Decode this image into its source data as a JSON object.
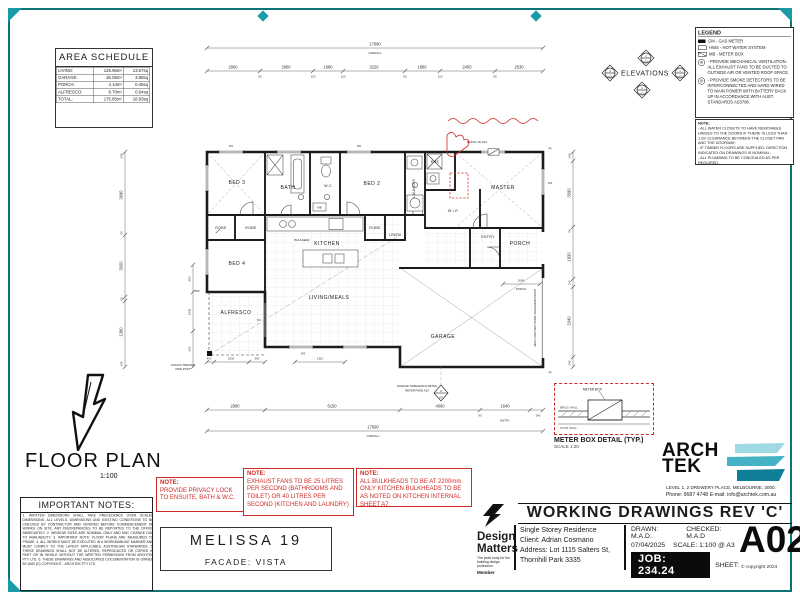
{
  "area_schedule": {
    "title": "AREA SCHEDULE",
    "rows": [
      {
        "name": "LIVING:",
        "m2": "126.96m²",
        "sq": "13.67sq"
      },
      {
        "name": "GARAGE:",
        "m2": "36.05m²",
        "sq": "3.88sq"
      },
      {
        "name": "PORCH:",
        "m2": "4.14m²",
        "sq": "0.45sq"
      },
      {
        "name": "ALFRESCO:",
        "m2": "8.70m²",
        "sq": "0.94sq"
      },
      {
        "name": "TOTAL:",
        "m2": "175.85m²",
        "sq": "18.93sq"
      }
    ]
  },
  "floor_plan_title": {
    "label": "FLOOR PLAN",
    "scale": "1:100"
  },
  "elevations": {
    "label": "ELEVATIONS",
    "top": "2",
    "right": "1",
    "bottom": "4",
    "left": "3",
    "sheet": "A3"
  },
  "legend": {
    "title": "LEGEND",
    "items": [
      "GM  -  GAS METER",
      "HWS  -  HOT WATER SYSTEM",
      "MB  -  METER BOX"
    ],
    "vent_note": "-  PROVIDE MECHANICAL VENTILATION. ALL EXHAUST FANS TO BE DUCTED TO OUTSIDE AIR OR VENTED ROOF SPACE.",
    "smoke_note": "-  PROVIDE SMOKE DETECTORS TO BE INTERCONNECTED AND HARD WIRED TO MAIN POWER WITH BATTERY BACK UP IN ACCORDANCE WITH AUST. STANDARDS AS3786."
  },
  "legend_note": {
    "title": "NOTE:",
    "line1": "- ALL WATER CLOSETS TO HAVE REMOVABLE HINGES TO THE DOORS IF THERE IS LESS THAN 1.2m CLEARANCE BETWEEN THE CLOSET PAN AND THE DOORWAY.",
    "line2": "- IF TIMBER FLOORS ARE SUPPLIED, DIRECTION INDICATED ON DRAWINGS IS NOMINAL.",
    "line3": "- ALL PLUMBING TO BE CONCEALED AS PER REQUIRED."
  },
  "important_notes": {
    "title": "IMPORTANT NOTES:",
    "body": "1. WRITTEN DIMENSIONS SHALL TAKE PRECEDENCE OVER SCALED DIMENSIONS. ALL LEVELS, DIMENSIONS AND EXISTING CONDITIONS TO BE CHECKED BY CONTRACTOR AND VERIFIED BEFORE COMMENCEMENT OF WORKS ON SITE. ANY DISCREPANCIES TO BE REPORTED TO THE OFFICE IMMEDIATELY. 2. WINDOW SIZES ARE NOMINAL ONLY AND MAY CHANGE DUE TO AVAILABILITY. 3. IMPORTANT NOTE: FLOOR PLANS ARE MEASURED TO FRAME. 4. ALL WORKS MUST BE EXECUTED IN A WORKMANLIKE MANNER AND MUST COMPLY TO THE LATEST APPLICABLE AUSTRALIAN STANDARDS. 5. THESE DRAWINGS SHALL NOT BE ALTERED, REPRODUCED OR COPIED IN PART OR IN WHOLE WITHOUT THE WRITTEN PERMISSION FROM ARCHTEK PTY LTD. 6. THESE DRAWINGS AND ASSOCIATED DOCUMENTATION IS OWNED BY AND (C) COPYRIGHT - ARCHTEK PTY LTD"
  },
  "red_notes": [
    {
      "title": "NOTE:",
      "body": "PROVIDE PRIVACY LOCK TO ENSUITE, BATH & W.C."
    },
    {
      "title": "NOTE:",
      "body": "EXHAUST FANS TO BE 25 LITRES PER SECOND (BATHROOMS AND TOILET) OR 40 LITRES PER SECOND (KITCHEN AND LAUNDRY)"
    },
    {
      "title": "NOTE:",
      "body": "ALL BULKHEADS TO BE AT 2200mm. ONLY KITCHEN BULKHEADS TO BE AS NOTED ON KITCHEN INTERNAL SHEET A7"
    }
  ],
  "title_box": {
    "name": "MELISSA 19",
    "facade": "FACADE: VISTA"
  },
  "meter_detail": {
    "title": "METER BOX DETAIL (TYP.)",
    "scale": "SCALE 1:20",
    "meter": "METER BOX",
    "brick": "BRICK WALL",
    "stud": "STUD WALL"
  },
  "archtek": {
    "line1": "ARCH",
    "line2": "TEK",
    "address": "LEVEL 1, 2 DREWERY PLACE, MELBOURNE, 3000.",
    "phone": "Phone: 9687 4748 E-mail: info@archtek.com.au"
  },
  "design_matters": {
    "line1": "Design",
    "line2": "Matters",
    "tagline1": "The peak body for the",
    "tagline2": "building design profession",
    "member": "Member"
  },
  "titleblock": {
    "header": "WORKING DRAWINGS REV 'C'",
    "project": "Single Storey Residence",
    "client": "Client: Adrian Cosmano",
    "address1": "Address: Lot 1115 Salters St,",
    "address2": "Thornhill Park 3335",
    "drawn": "DRAWN:  M.A.D.",
    "checked": "CHECKED:  M.A.D",
    "date": "07/04/2025",
    "scale": "SCALE: 1:100 @ A3",
    "job": "JOB:  234.24",
    "sheet_label": "SHEET:",
    "sheet": "A02",
    "copyright": "© copyright 2024"
  },
  "floor_plan": {
    "rooms": {
      "bed3": "BED 3",
      "bath": "BATH",
      "wc": "W.C",
      "bed2": "BED 2",
      "laundry": "LAUNDRY",
      "ens": "ENS",
      "master": "MASTER",
      "wir": "W.I.R",
      "robe_a": "ROBE",
      "robe_b": "ROBE",
      "robe_c": "ROBE",
      "linen": "LINEN",
      "kitchen": "KITCHEN",
      "bed4": "BED 4",
      "alfresco": "ALFRESCO",
      "living": "LIVING/MEALS",
      "entry": "ENTRY",
      "porch": "PORCH",
      "garage": "GARAGE"
    },
    "dims": {
      "overall_top": "17690",
      "overall_word": "OVERALL",
      "top": [
        "2900",
        "2900",
        "1680",
        "3220",
        "1880",
        "2450",
        "2530"
      ],
      "top_small": [
        "90",
        "110",
        "110",
        "90",
        "110",
        "90"
      ],
      "bottom": [
        "2990",
        "6150",
        "4060",
        "1640"
      ],
      "bottom_small": [
        "90",
        "240"
      ],
      "overall_bottom": "17690",
      "alfresco": [
        "470",
        "2530",
        "390",
        "1310"
      ],
      "left": [
        "3690",
        "3000",
        "1380"
      ],
      "left_small": [
        "240",
        "90",
        "90",
        "240"
      ],
      "left_inner": [
        "850",
        "2440",
        "420"
      ],
      "right": [
        "3590",
        "1930",
        "2040"
      ],
      "right_small": [
        "240",
        "90",
        "110",
        "240"
      ],
      "porch_width": "2040",
      "porch_word": "PORCH",
      "entry_word": "ENTRY"
    },
    "tags": {
      "w1": "W1",
      "w2": "W2",
      "w3": "W3",
      "w4": "W4",
      "d3": "D3",
      "dp": "dp"
    },
    "notes": {
      "detail": "DETAIL ON A13",
      "post1": "100x100 TREATED",
      "post2": "PINE POST",
      "threshold1": "GARAGE THRESHOLD DETAIL",
      "threshold2": "REFER PAGE A13",
      "garage_door": "4800 x 2400 SECTIONAL OVERHEAD DOOR",
      "section_letter": "A",
      "section_sheet": "A3",
      "tap": "TAP",
      "mb": "MB",
      "bulkhead": "BULKHEAD"
    }
  }
}
